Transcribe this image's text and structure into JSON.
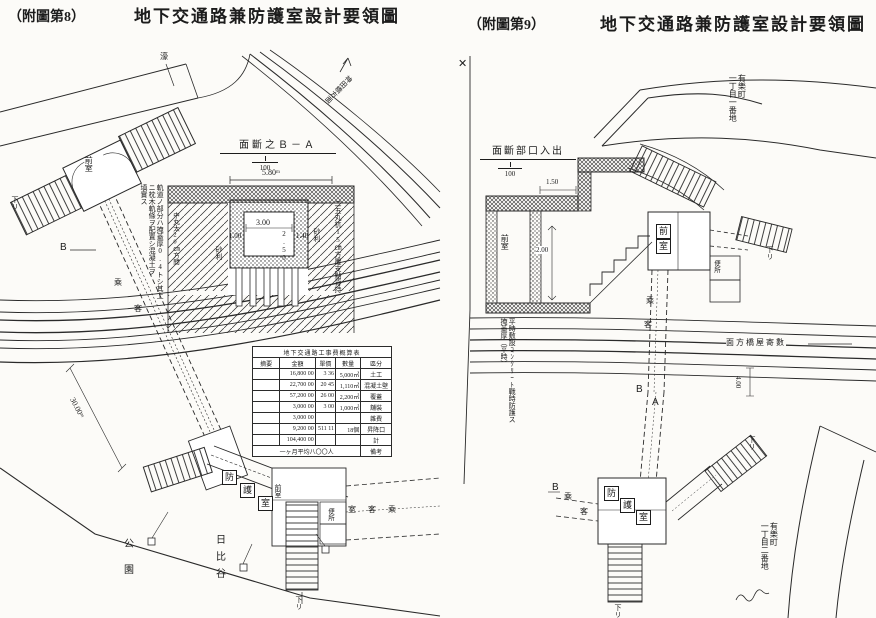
{
  "page": {
    "bg": "#fcfbf8",
    "ink": "#1c1c1c"
  },
  "left": {
    "fig_no": "（附圖第8）",
    "title": "地下交通路兼防護室設計要領圖",
    "moat": "濠",
    "road_direction": "神田橋方面",
    "marker_b": "B",
    "corridor_chars": [
      "乘",
      "客"
    ],
    "dim_corridor": "30.00ᵐ",
    "structure_top": {
      "room": "前室",
      "down": "下リ"
    },
    "shelter_chars": [
      "防",
      "護",
      "室"
    ],
    "structure_bottom": {
      "room": "前室",
      "passenger_room": "室客乘",
      "toilet": "便所",
      "down": "下リ"
    },
    "park": {
      "col_right": "日比谷",
      "col_left": "公園"
    },
    "section": {
      "title": "面斷之Ｂ－Ａ",
      "scale": "100",
      "dim_top": "5.80ᵐ",
      "dim_inner_w": "3.00",
      "dim_inner_h": "2.50",
      "dim_wall_left": "1.00",
      "dim_wall_right": "1.40",
      "gravel_left": "砂利",
      "gravel_right": "砂利",
      "note_cols": [
        "軌道ノ部分ハ掩蓋厚0.4トシ其上",
        "ニ枕木軌條ヲ配置シ混凝土ヲ",
        "填實ス"
      ],
      "note_inner": "中丸太20㎝方間",
      "note_right": "二五丸杭15㎝方覆支點背持"
    },
    "table": {
      "title": "地下交通路工事費概算表",
      "headers": [
        "摘要",
        "金額",
        "單價",
        "數量",
        "區分"
      ],
      "rows": [
        {
          "note": "",
          "amount": "16,800 00",
          "unit": "3 36",
          "qty": "5,000㎥",
          "item": "土工"
        },
        {
          "note": "",
          "amount": "22,700 00",
          "unit": "20 45",
          "qty": "1,110㎥",
          "item": "混凝土壁"
        },
        {
          "note": "",
          "amount": "57,200 00",
          "unit": "26 00",
          "qty": "2,200㎡",
          "item": "覆蓋"
        },
        {
          "note": "",
          "amount": "3,000 00",
          "unit": "3 00",
          "qty": "1,000㎡",
          "item": "舖裝"
        },
        {
          "note": "",
          "amount": "3,000 00",
          "unit": "",
          "qty": "",
          "item": "雜費"
        },
        {
          "note": "",
          "amount": "9,200 00",
          "unit": "511 11",
          "qty": "18個",
          "item": "昇降口"
        },
        {
          "note": "",
          "amount": "104,400 00",
          "unit": "",
          "qty": "",
          "item": "計"
        }
      ],
      "note": "一ヶ月平均八〇〇人",
      "remark": "備考"
    }
  },
  "right": {
    "fig_no": "（附圖第9）",
    "title": "地下交通路兼防護室設計要領圖",
    "x_marker": "✕",
    "section": {
      "title": "面斷部口入出",
      "scale": "100",
      "dim_step": "1.50",
      "dim_height": "2.00",
      "room": "前室",
      "notes": [
        "平時敷設ｺﾝｸﾘｰﾄ戰時防護ス",
        "掩蓋厚（平時）"
      ]
    },
    "addr_top": {
      "col_right": "有樂町",
      "col_left": "一丁目一番地"
    },
    "addr_bottom": {
      "col_right": "有樂町",
      "col_left": "一丁目二番地"
    },
    "road_direction": "面方橋屋寄數",
    "dim_road": "4.00",
    "marker_a": "A",
    "marker_b": "B",
    "marker_b2": "B",
    "toilet": "便所",
    "room_chars": [
      "前",
      "室"
    ],
    "shelter_chars": [
      "防",
      "護",
      "室"
    ],
    "corridor_chars": [
      "乘",
      "客"
    ],
    "down_labels": [
      "下リ",
      "下リ",
      "下リ"
    ]
  }
}
